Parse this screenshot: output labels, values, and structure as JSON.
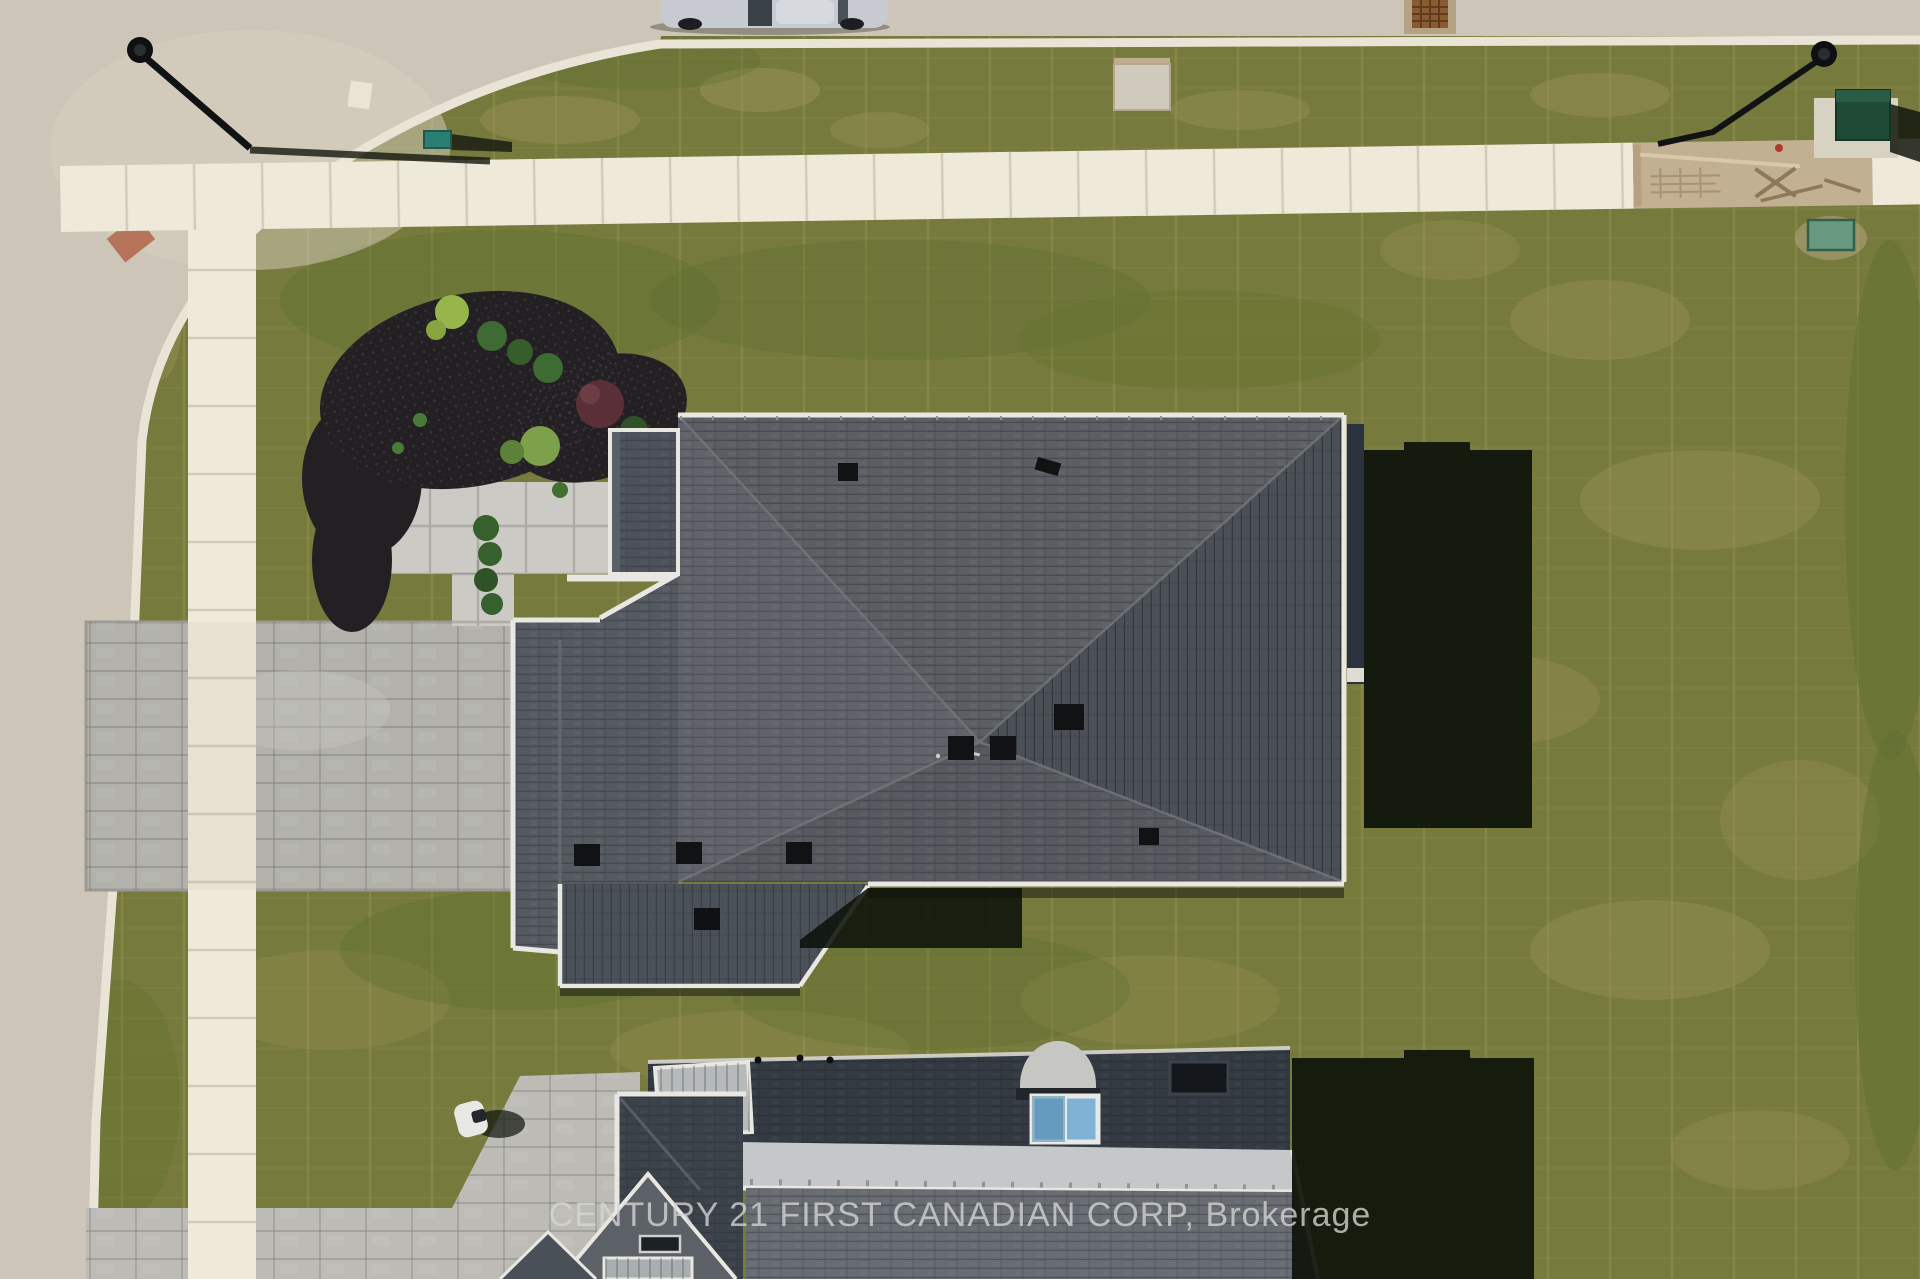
{
  "watermark": {
    "text": "CENTURY 21 FIRST CANADIAN CORP, Brokerage",
    "color": "#d6d6d3"
  },
  "palette": {
    "grass": "#767a3c",
    "grass_dark": "#5f7030",
    "grass_dry": "#9b9159",
    "road": "#cdc6b8",
    "curb": "#eae4d6",
    "sidewalk": "#efe9da",
    "dirt": "#c2b092",
    "paver_driveway": "#b2b1ac",
    "paver_entry": "#cbcac5",
    "paver_neighbor": "#bcbbb6",
    "mulch": "#232024",
    "shrub_green": "#3e6b33",
    "shrub_red": "#5a2f38",
    "roof_north": "#5b5f64",
    "roof_east": "#4b5057",
    "roof_south": "#565a60",
    "roof_west": "#60646a",
    "roof_garage": "#555a61",
    "roof_porch": "#4c515b",
    "roof_rear": "#4b5158",
    "fascia": "#e9e7e1",
    "wall_shade": "#2b3340",
    "lower_roof_shaded": "#333a42",
    "lower_roof_sunlit": "#676c72",
    "lower_roof_metal": "#c4c8c8",
    "skylight_glass": "#7fb2d4",
    "shadow": "#0d120a",
    "utility_green_dark": "#1e4a36",
    "utility_green_light": "#679a80",
    "utility_teal": "#2a7e72",
    "car_silver": "#c7cad0",
    "tactile_red": "#b26a50",
    "grate_rust": "#8a5a30"
  },
  "scene": {
    "objects": [
      "asphalt street corner",
      "concrete sidewalk",
      "unpoured sidewalk section with form boards",
      "interlocking paver driveway",
      "front entry paver walkway",
      "mulch garden bed with shrubs",
      "hip-roof bungalow with dark shingles",
      "roof vents",
      "cast building shadows",
      "neighbouring house roof with arched dormer and skylights",
      "neighbour paver driveway",
      "parked silver car",
      "black street lamps with long shadows",
      "green utility cabinets",
      "storm drain grate",
      "fresh sod lawn with visible seams"
    ]
  }
}
